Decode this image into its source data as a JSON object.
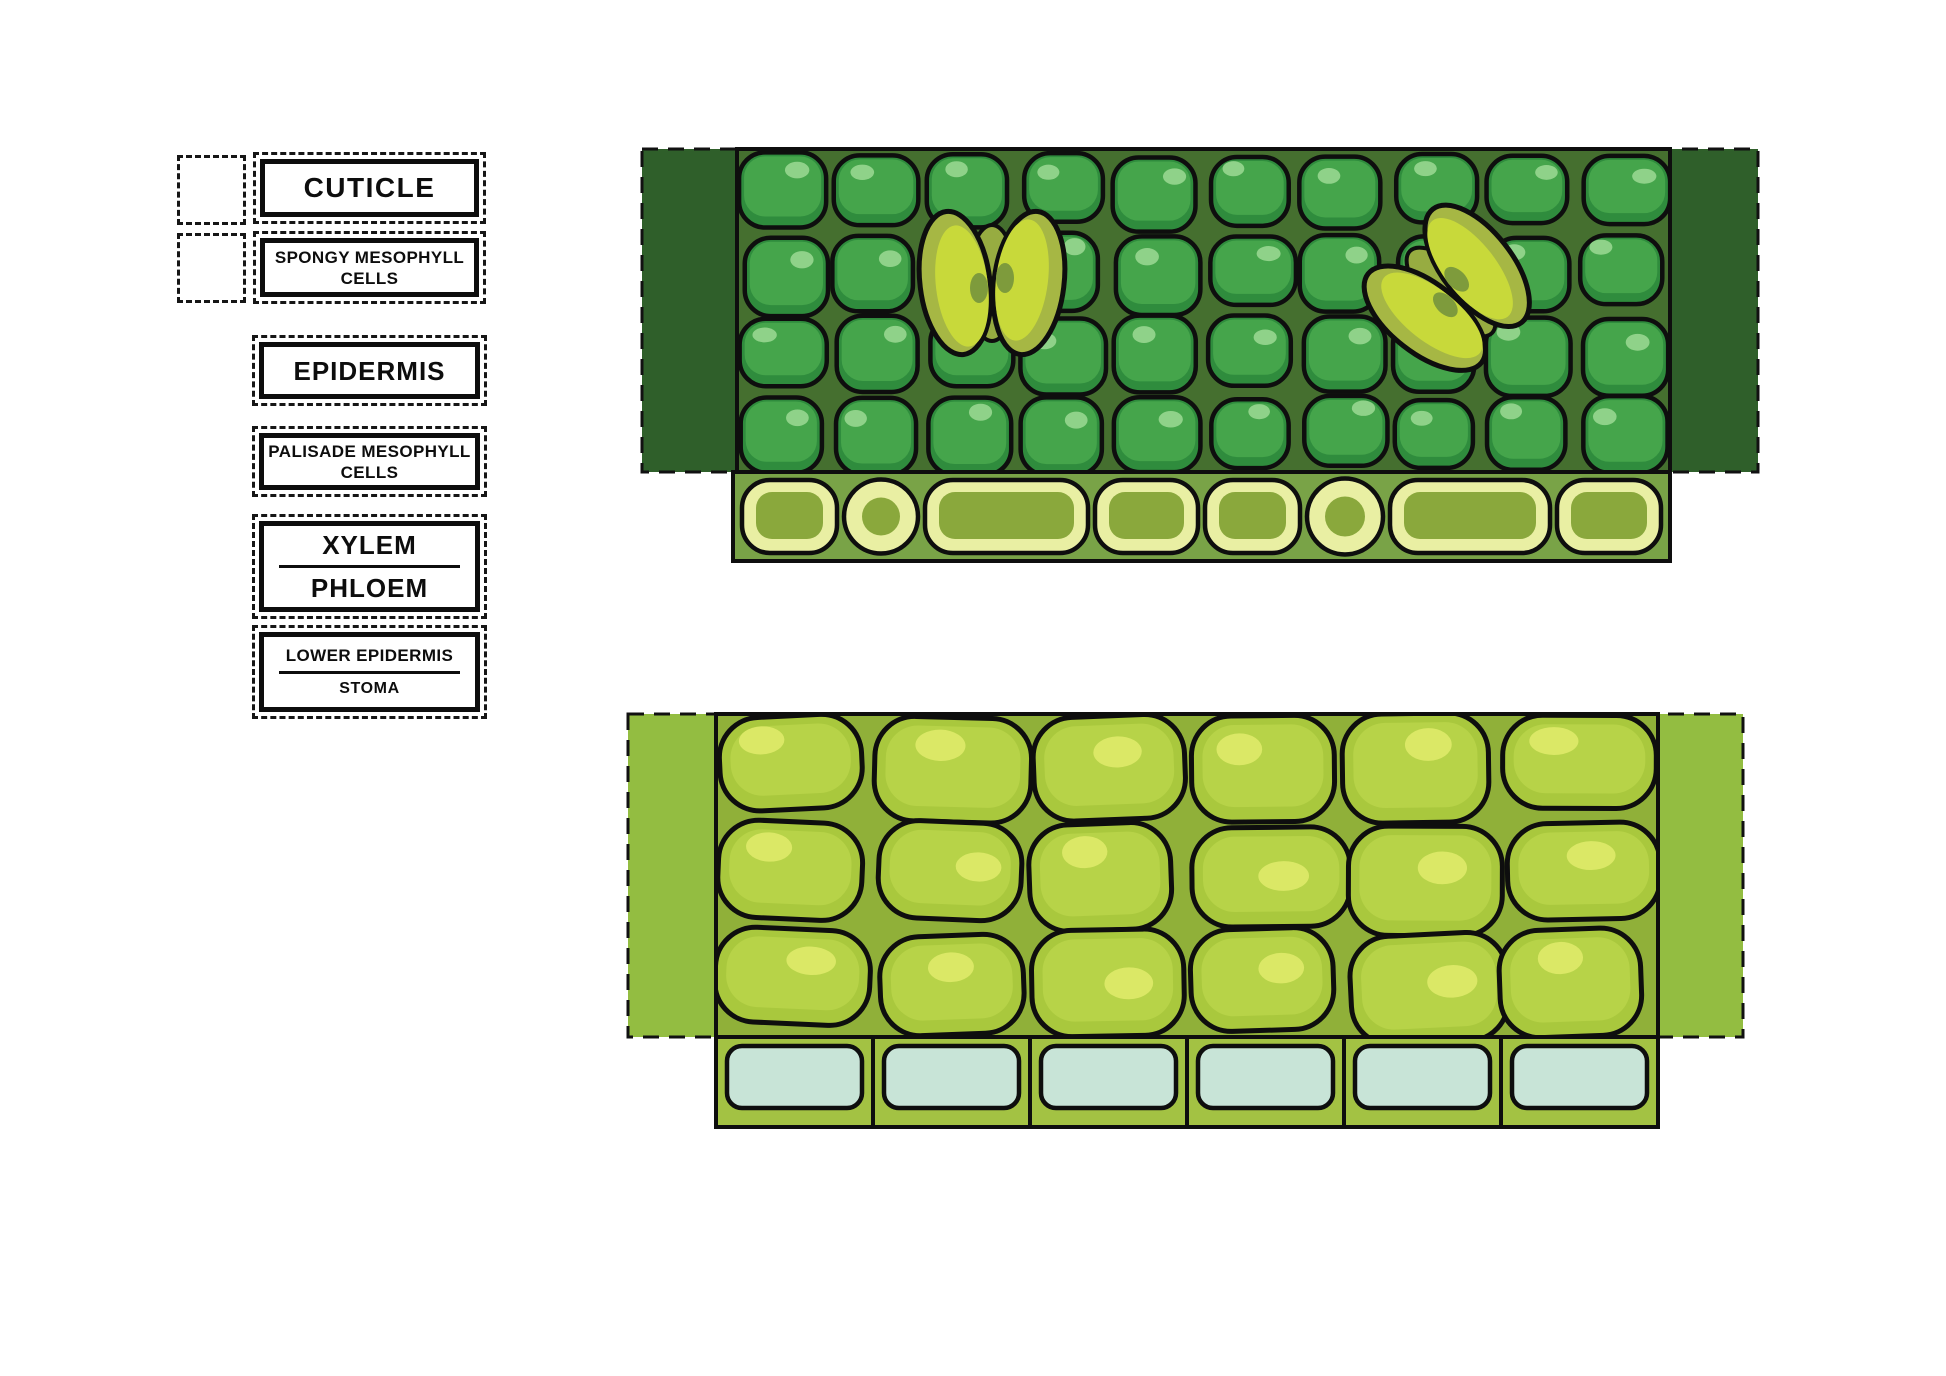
{
  "document": {
    "background": "#ffffff",
    "description": "Leaf cross-section cut-and-label worksheet"
  },
  "label_panel": {
    "items": [
      {
        "id": "cuticle",
        "lines": [
          "CUTICLE"
        ],
        "size": "big",
        "divider": false
      },
      {
        "id": "spongy-mesophyll-cells",
        "lines": [
          "SPONGY MESOPHYLL",
          "CELLS"
        ],
        "size": "small",
        "divider": false
      },
      {
        "id": "epidermis",
        "lines": [
          "EPIDERMIS"
        ],
        "size": "med",
        "divider": false
      },
      {
        "id": "palisade-mesophyll-cells",
        "lines": [
          "PALISADE MESOPHYLL",
          "CELLS"
        ],
        "size": "small",
        "divider": false
      },
      {
        "id": "xylem-phloem",
        "lines": [
          "XYLEM",
          "PHLOEM"
        ],
        "size": "med",
        "divider": true
      },
      {
        "id": "lower-epidermis-stoma",
        "lines": [
          "LOWER EPIDERMIS",
          "STOMA"
        ],
        "size": "small",
        "divider": true
      }
    ]
  },
  "upper_illustration": {
    "band": {
      "x": 642,
      "y": 149,
      "w": 1116,
      "h": 323,
      "fill": "#2F5F2A"
    },
    "region": {
      "x": 737,
      "y": 149,
      "w": 933,
      "h": 323,
      "bg": "#456F2F"
    },
    "cell_colors": {
      "base": "#2F8C3D",
      "inner": "#45A54B",
      "gloss": "#93D48C",
      "outline": "#0E0E0E"
    },
    "grid": {
      "cols": 10,
      "rows": 4
    },
    "stomata": [
      {
        "cx": 992,
        "cy": 283,
        "rotate": 0
      },
      {
        "cx": 1451,
        "cy": 292,
        "rotate": -45
      }
    ],
    "stoma_colors": {
      "bright": "#C8D93A",
      "rim": "#A6B744",
      "spot": "#7E9B3C",
      "seam": "#97AC41"
    },
    "strip": {
      "x": 733,
      "y": 472,
      "w": 937,
      "h": 89,
      "bg": "#79A347",
      "cell_fill": "#E9EFA3",
      "cell_inner": "#8AA83C",
      "pattern": [
        {
          "shape": "rect",
          "w": 95
        },
        {
          "shape": "circle",
          "w": 74
        },
        {
          "shape": "rect",
          "w": 163
        },
        {
          "shape": "rect",
          "w": 103
        },
        {
          "shape": "rect",
          "w": 95
        },
        {
          "shape": "circle",
          "w": 76
        },
        {
          "shape": "rect",
          "w": 160
        },
        {
          "shape": "rect",
          "w": 104
        }
      ]
    }
  },
  "lower_illustration": {
    "band": {
      "x": 628,
      "y": 714,
      "w": 1115,
      "h": 323,
      "fill": "#93BD41"
    },
    "region": {
      "x": 716,
      "y": 714,
      "w": 942,
      "h": 323,
      "bg": "#90B039"
    },
    "cell_colors": {
      "base": "#A9C83D",
      "inner": "#B7D348",
      "gloss": "#DCE968",
      "outline": "#0E0E0E"
    },
    "grid": {
      "cols": 6,
      "rows": 3
    },
    "blue_row": {
      "x": 716,
      "y": 1037,
      "w": 942,
      "h": 90,
      "bg": "#A3C243",
      "cell_fill": "#C8E4D7",
      "cells": 6
    }
  }
}
